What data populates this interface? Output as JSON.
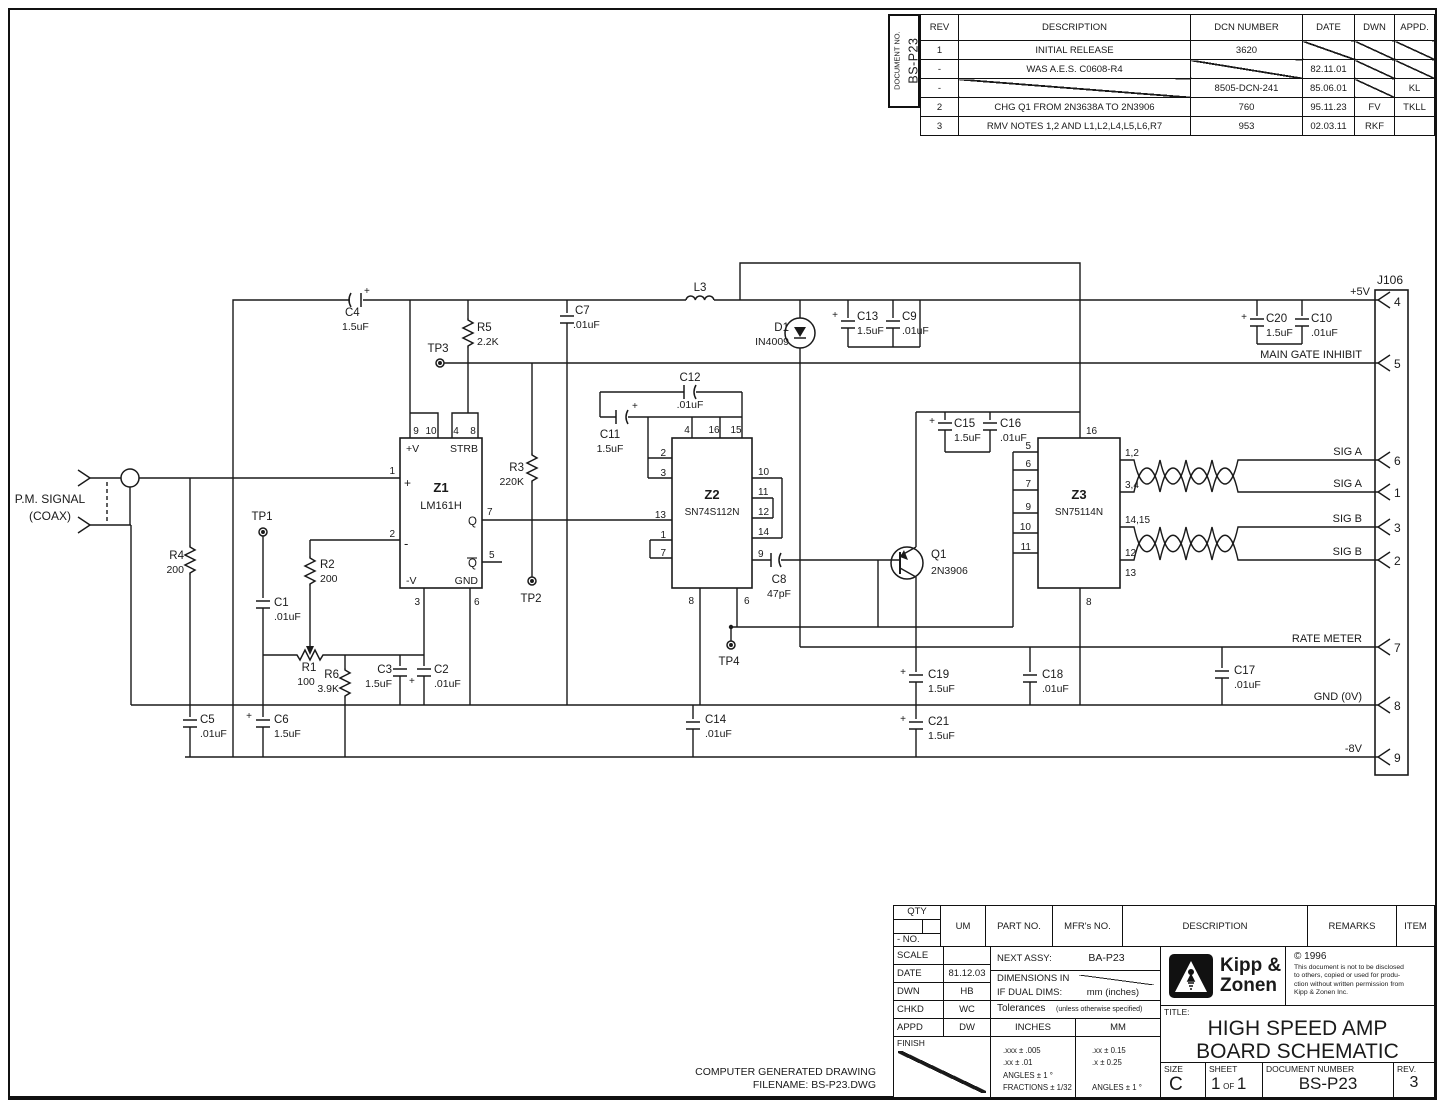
{
  "rev_table": {
    "doc_label": "DOCUMENT NO.",
    "doc_number": "BS-P23",
    "headers": [
      "REV",
      "DESCRIPTION",
      "DCN NUMBER",
      "DATE",
      "DWN",
      "APPD."
    ],
    "rows": [
      {
        "rev": "1",
        "desc": "INITIAL RELEASE",
        "dcn": "3620",
        "date": "",
        "dwn": "",
        "appd": ""
      },
      {
        "rev": "-",
        "desc": "WAS A.E.S. C0608-R4",
        "dcn": "",
        "date": "82.11.01",
        "dwn": "",
        "appd": ""
      },
      {
        "rev": "-",
        "desc": "",
        "dcn": "8505-DCN-241",
        "date": "85.06.01",
        "dwn": "",
        "appd": "KL"
      },
      {
        "rev": "2",
        "desc": "CHG Q1 FROM 2N3638A TO 2N3906",
        "dcn": "760",
        "date": "95.11.23",
        "dwn": "FV",
        "appd": "TKLL"
      },
      {
        "rev": "3",
        "desc": "RMV NOTES 1,2 AND L1,L2,L4,L5,L6,R7",
        "dcn": "953",
        "date": "02.03.11",
        "dwn": "RKF",
        "appd": ""
      }
    ]
  },
  "sch": {
    "pm1": "P.M. SIGNAL",
    "pm2": "(COAX)",
    "plus": "+",
    "tp1": "TP1",
    "tp2": "TP2",
    "tp3": "TP3",
    "tp4": "TP4",
    "r1": {
      "ref": "R1",
      "val": "100"
    },
    "r2": {
      "ref": "R2",
      "val": "200"
    },
    "r3": {
      "ref": "R3",
      "val": "220K"
    },
    "r4": {
      "ref": "R4",
      "val": "200"
    },
    "r5": {
      "ref": "R5",
      "val": "2.2K"
    },
    "r6": {
      "ref": "R6",
      "val": "3.9K"
    },
    "c1": {
      "ref": "C1",
      "val": ".01uF"
    },
    "c2": {
      "ref": "C2",
      "val": ".01uF"
    },
    "c3": {
      "ref": "C3",
      "val": "1.5uF"
    },
    "c4": {
      "ref": "C4",
      "val": "1.5uF"
    },
    "c5": {
      "ref": "C5",
      "val": ".01uF"
    },
    "c6": {
      "ref": "C6",
      "val": "1.5uF"
    },
    "c7": {
      "ref": "C7",
      "val": ".01uF"
    },
    "c8": {
      "ref": "C8",
      "val": "47pF"
    },
    "c9": {
      "ref": "C9",
      "val": ".01uF"
    },
    "c10": {
      "ref": "C10",
      "val": ".01uF"
    },
    "c11": {
      "ref": "C11",
      "val": "1.5uF"
    },
    "c12": {
      "ref": "C12",
      "val": ".01uF"
    },
    "c13": {
      "ref": "C13",
      "val": "1.5uF"
    },
    "c14": {
      "ref": "C14",
      "val": ".01uF"
    },
    "c15": {
      "ref": "C15",
      "val": "1.5uF"
    },
    "c16": {
      "ref": "C16",
      "val": ".01uF"
    },
    "c17": {
      "ref": "C17",
      "val": ".01uF"
    },
    "c18": {
      "ref": "C18",
      "val": ".01uF"
    },
    "c19": {
      "ref": "C19",
      "val": "1.5uF"
    },
    "c20": {
      "ref": "C20",
      "val": "1.5uF"
    },
    "c21": {
      "ref": "C21",
      "val": "1.5uF"
    },
    "l3": "L3",
    "d1": {
      "ref": "D1",
      "val": "IN4009"
    },
    "q1": {
      "ref": "Q1",
      "val": "2N3906"
    },
    "z1": {
      "ref": "Z1",
      "part": "LM161H",
      "p9": "9",
      "p10": "10",
      "p4": "4",
      "p8": "8",
      "vp": "+V",
      "strb": "STRB",
      "p1": "1",
      "p2": "2",
      "pin_plus": "+",
      "pin_minus": "-",
      "q": "Q",
      "qb": "Q",
      "p7": "7",
      "p5": "5",
      "vm": "-V",
      "gnd": "GND",
      "p3": "3",
      "p6": "6"
    },
    "z2": {
      "ref": "Z2",
      "part": "SN74S112N",
      "p4": "4",
      "p16": "16",
      "p15": "15",
      "p2": "2",
      "p3": "3",
      "p13": "13",
      "p1": "1",
      "p7": "7",
      "p10": "10",
      "p11": "11",
      "p12": "12",
      "p14": "14",
      "p9": "9",
      "p8": "8",
      "p6": "6"
    },
    "z3": {
      "ref": "Z3",
      "part": "SN75114N",
      "p16": "16",
      "p5": "5",
      "p6": "6",
      "p7": "7",
      "p9": "9",
      "p10": "10",
      "p11": "11",
      "p8": "8",
      "p12a": "1,2",
      "p34": "3,4",
      "p1415": "14,15",
      "p12": "12",
      "p13": "13"
    },
    "j106": "J106",
    "jp": {
      "p4": "4",
      "p5": "5",
      "p6": "6",
      "p1": "1",
      "p3": "3",
      "p2": "2",
      "p7": "7",
      "p8": "8",
      "p9": "9"
    },
    "nets": {
      "v5": "+5V",
      "mgi": "MAIN GATE INHIBIT",
      "siga": "SIG A",
      "sigb": "SIG B",
      "rate": "RATE METER",
      "gnd": "GND (0V)",
      "v8": "-8V"
    }
  },
  "parts_table": {
    "qty": "QTY",
    "no": "- NO.",
    "um": "UM",
    "part_no": "PART NO.",
    "mfrs_no": "MFR's NO.",
    "description": "DESCRIPTION",
    "remarks": "REMARKS",
    "item": "ITEM"
  },
  "tb": {
    "scale_label": "SCALE",
    "date_label": "DATE",
    "date": "81.12.03",
    "dwn_label": "DWN",
    "dwn": "HB",
    "chkd_label": "CHKD",
    "chkd": "WC",
    "appd_label": "APPD",
    "appd": "DW",
    "finish_label": "FINISH",
    "next_assy_label": "NEXT ASSY:",
    "next_assy": "BA-P23",
    "dims_label": "DIMENSIONS IN",
    "dual_label": "IF DUAL DIMS:",
    "dual_value": "mm (inches)",
    "tol_label": "Tolerances",
    "tol_note": "(unless otherwise specified)",
    "inches_label": "INCHES",
    "mm_label": "MM",
    "tol_inches": [
      ".xxx ± .005",
      ".xx ± .01",
      "ANGLES ± 1 °",
      "FRACTIONS ± 1/32"
    ],
    "tol_mm": [
      ".xx ± 0.15",
      ".x ± 0.25",
      "ANGLES ± 1 °"
    ],
    "brand1": "Kipp &",
    "brand2": "Zonen",
    "copyright": "© 1996",
    "copy_lines": [
      "This document is not to be disclosed",
      "to others, copied or used for produ-",
      "ction without written permission from",
      "Kipp & Zonen Inc."
    ],
    "title_label": "TITLE:",
    "title1": "HIGH SPEED AMP",
    "title2": "BOARD SCHEMATIC",
    "size_label": "SIZE",
    "size": "C",
    "sheet_label": "SHEET",
    "sheet_n1": "1",
    "sheet_of": "OF",
    "sheet_n2": "1",
    "docnum_label": "DOCUMENT NUMBER",
    "docnum": "BS-P23",
    "rev_label": "REV.",
    "rev": "3"
  },
  "footer": {
    "line1": "COMPUTER GENERATED DRAWING",
    "line2": "FILENAME: BS-P23.DWG"
  }
}
